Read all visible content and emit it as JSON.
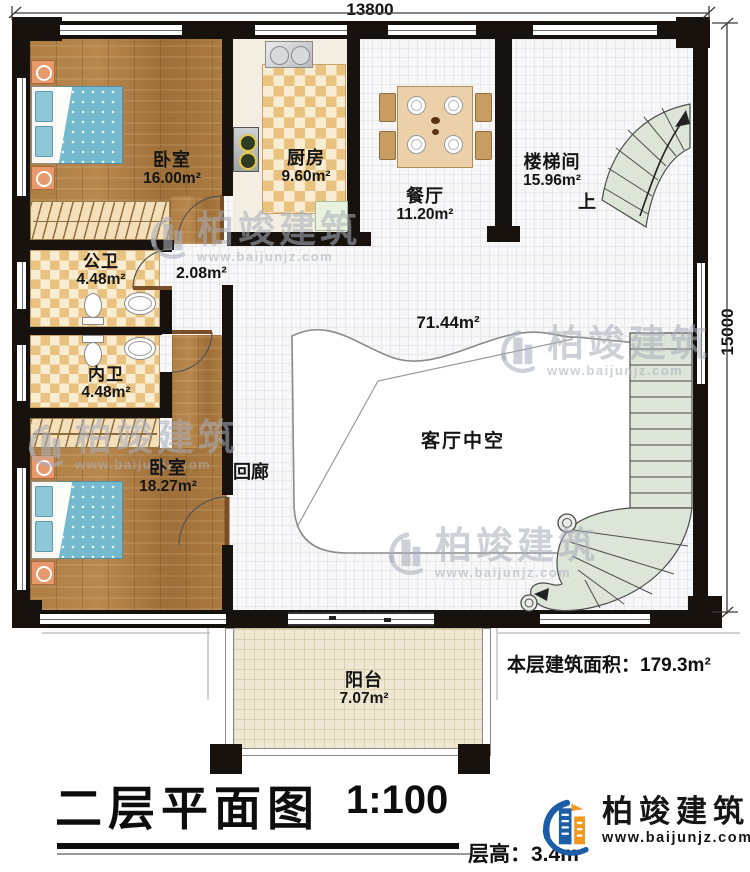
{
  "plan": {
    "dimensions": {
      "width_top": "13800",
      "height_right": "15000"
    },
    "rooms": {
      "bedroom_top": {
        "name": "卧室",
        "area": "16.00m²"
      },
      "kitchen": {
        "name": "厨房",
        "area": "9.60m²"
      },
      "dining": {
        "name": "餐厅",
        "area": "11.20m²"
      },
      "stairwell": {
        "name": "楼梯间",
        "area": "15.96m²",
        "direction": "上"
      },
      "public_bath": {
        "name": "公卫",
        "area": "4.48m²"
      },
      "hall_nook": {
        "area": "2.08m²"
      },
      "private_bath": {
        "name": "内卫",
        "area": "4.48m²"
      },
      "bedroom_bottom": {
        "name": "卧室",
        "area": "18.27m²"
      },
      "corridor": {
        "name": "回廊"
      },
      "living_void": {
        "name": "客厅中空",
        "area": "71.44m²"
      },
      "balcony": {
        "name": "阳台",
        "area": "7.07m²"
      }
    },
    "notes": {
      "floor_area_label": "本层建筑面积：",
      "floor_area_value": "179.3m²"
    }
  },
  "titleblock": {
    "title": "二层平面图",
    "scale": "1:100",
    "floor_height_label": "层高：",
    "floor_height_value": "3.4m"
  },
  "branding": {
    "company": "柏竣建筑",
    "website": "www.baijunjz.com"
  },
  "colors": {
    "wall": "#17120d",
    "logo_blue": "#1b5ea6",
    "logo_orange": "#f2981d",
    "stair": "#dde4d8"
  }
}
